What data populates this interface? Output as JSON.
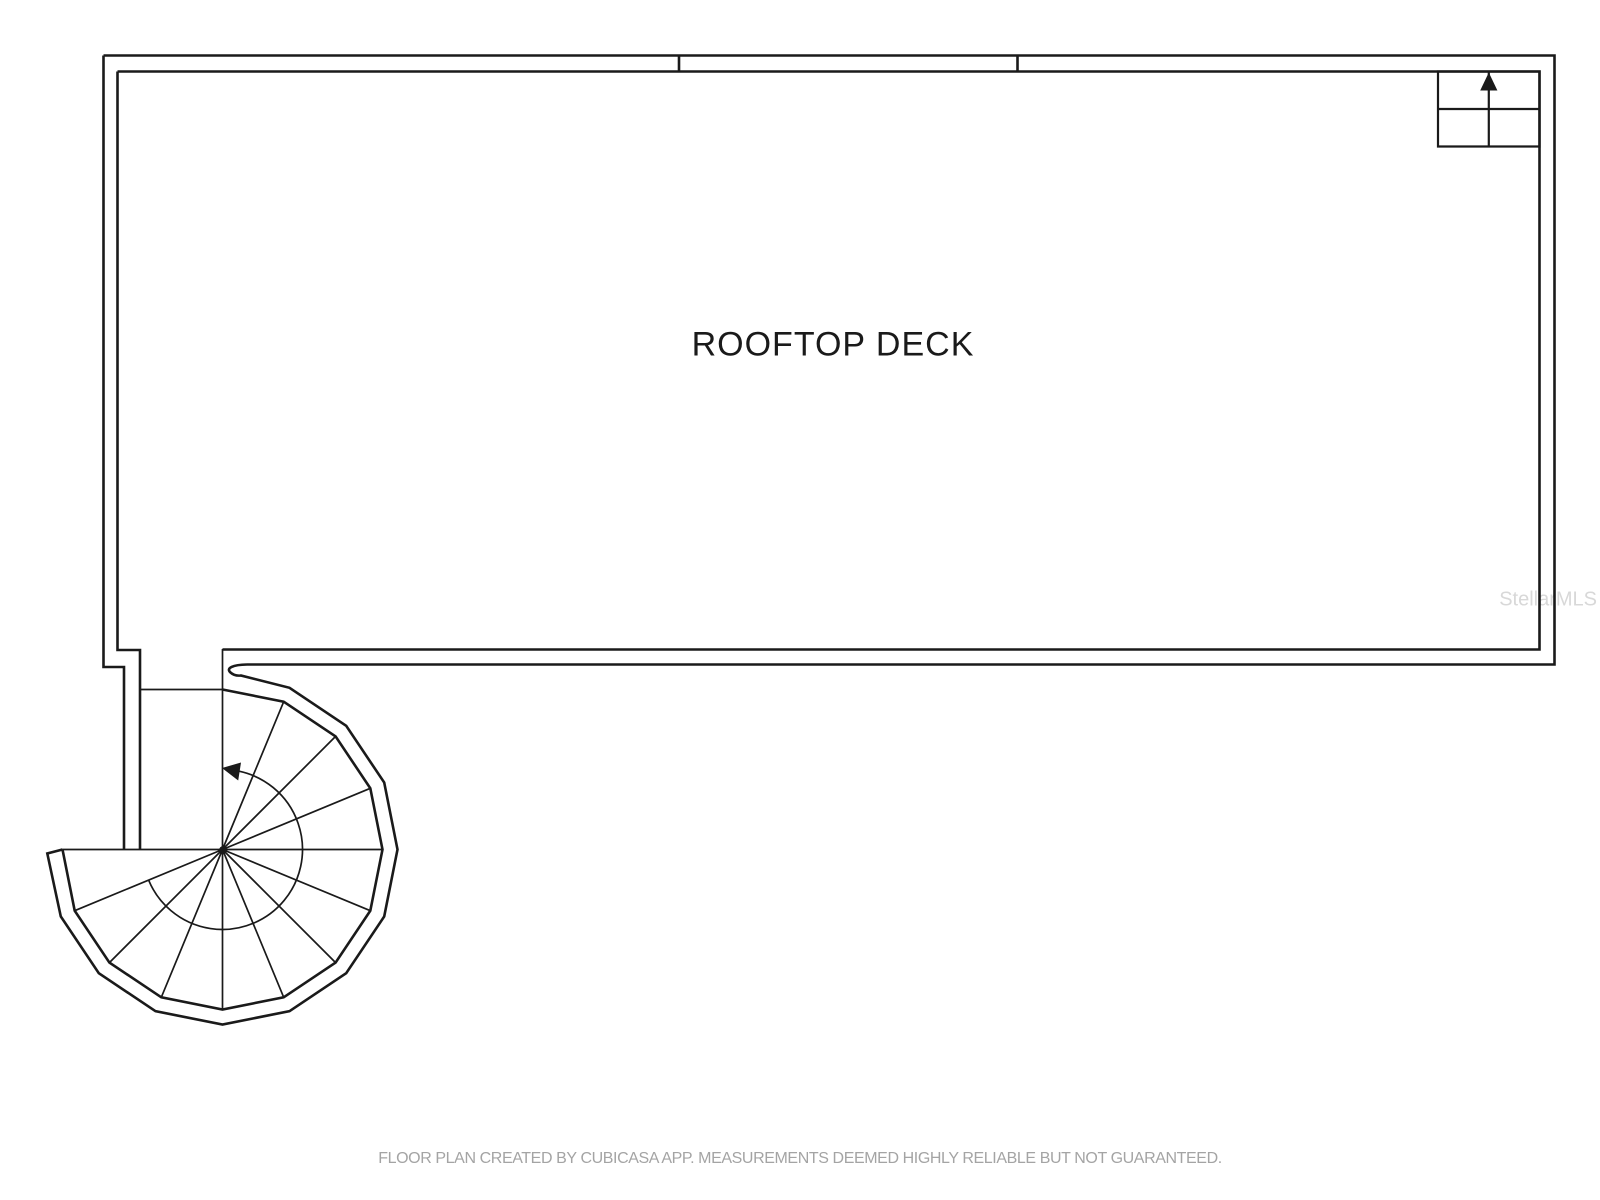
{
  "floor_plan": {
    "room_label": "ROOFTOP DECK",
    "watermark": "StellarMLS",
    "footer": "FLOOR PLAN CREATED BY CUBICASA APP. MEASUREMENTS DEEMED HIGHLY RELIABLE BUT NOT GUARANTEED.",
    "icons": {
      "north_arrow": "north-arrow-icon",
      "stair_direction": "stair-direction-arrow-icon"
    },
    "colors": {
      "background": "#ffffff",
      "wall_line": "#1a1a1a",
      "room_label_text": "#1a1a1a",
      "footer_text": "#a4a4a4",
      "watermark_text": "#d8d8d8"
    }
  }
}
